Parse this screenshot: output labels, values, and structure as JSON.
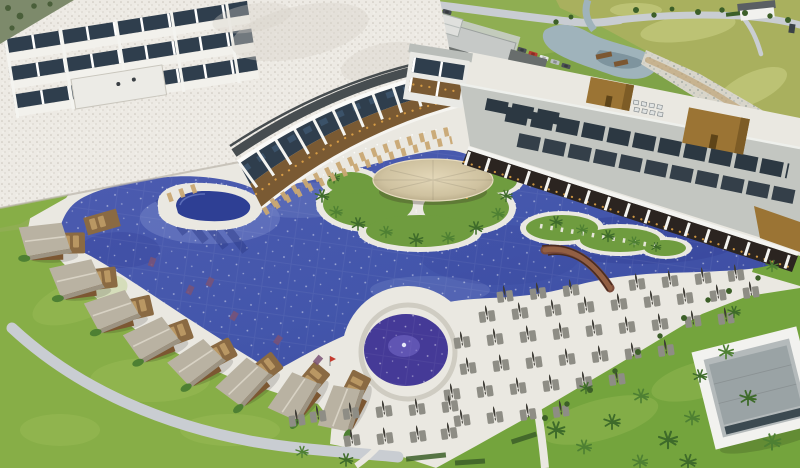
{
  "meta": {
    "type": "aerial-photograph",
    "description": "Aerial view of a luxury resort at dusk: a curved white hotel tower and two colonnaded restaurant wings with warm lit interiors wrap around a huge royal-blue lagoon pool; a thatched swim-up bar sits on a palm-planted island in the middle; thatched-roof cabanas with private decks line the left edge; a round splash pool with a fountain sits at bottom centre; rows of grey sun loungers with closed parasols fill a white deck on the right; lawns, young palms, a stream, rocky banks and golf fairways stretch behind.",
    "width": 800,
    "height": 468
  },
  "palette": {
    "bg_green": "#8fae52",
    "golf": "#a9b05e",
    "golf_light": "#bcc274",
    "lawn": "#87ae47",
    "lawn_bright": "#74a43d",
    "lawn_light": "#a7c45f",
    "terrain": "#7d8a6b",
    "emb": "#7fa348",
    "road": "#c9cdd2",
    "dirt": "#c2a77c",
    "rock": "#d8d5ca",
    "stream": "#9fb3bb",
    "pond_dark": "#7e949e",
    "house_roof": "#5a5f63",
    "white": "#f4f3ef",
    "deck": "#eae8e1",
    "deck_shadow": "#d6d3ca",
    "pool": "#4356ab",
    "pool_hi": "#4d5cb0",
    "pool_lo": "#3a479d",
    "pool_dark": "#36439a",
    "pool_light": "#8291cf",
    "pool_navy": "#2e3f94",
    "pool_purple": "#453a97",
    "island_green": "#6f9c3f",
    "palm": "#3e6b2a",
    "palm_light": "#4e8033",
    "hedge": "#3c5f28",
    "bar_roof_1": "#e3d7b8",
    "bar_roof_2": "#cfc2a0",
    "bar_roof_3": "#a89a78",
    "thatch": "#b9b2a2",
    "thatch_dark": "#9c9382",
    "wood": "#7c5732",
    "wood_deck": "#8a6a43",
    "cab_lounger": "#b99763",
    "facade": "#edeae4",
    "facade_dot": "#c9c4ba",
    "window_dark": "#2f3e4d",
    "window_blue": "#3f5871",
    "roof_dark_band": "#474d50",
    "roof_gray": "#c3c6c1",
    "skylight": "#2c3842",
    "bronze": "#9b7434",
    "bronze_dark": "#7d5c26",
    "interior_dark": "#2b2420",
    "warm": "#e0a347",
    "warm_deep": "#7a5a33",
    "column_white": "#f4f4f0",
    "lounger": "#8e8d85",
    "lounger_tan": "#c9a873",
    "umbrella": "#3f3d37",
    "bridge": "#7a4a3a",
    "bridge_light": "#925f43",
    "ac_unit": "#e0e3e2",
    "car_red": "#b63c30",
    "car_white": "#e8eaea",
    "car_dark": "#4a4f55",
    "car_silver": "#b9bec2",
    "flag_red": "#c43b2e"
  },
  "features": [
    {
      "id": "hotel-tower",
      "label": "white hotel tower with balconies"
    },
    {
      "id": "curved-restaurant-wing",
      "label": "curved two-storey colonnade with lit restaurants"
    },
    {
      "id": "right-restaurant-wing",
      "label": "flat-roofed colonnade wing with skylights"
    },
    {
      "id": "bronze-rooftop-boxes",
      "label": "bronze rooftop volumes"
    },
    {
      "id": "main-pool",
      "label": "free-form lagoon pool"
    },
    {
      "id": "swim-up-bar-island",
      "label": "island with round thatched swim-up bar"
    },
    {
      "id": "stepping-stone-island",
      "label": "planted island with stepping stones"
    },
    {
      "id": "wooden-bridge",
      "label": "arched wooden bridge"
    },
    {
      "id": "cabana-row",
      "label": "thatched cabanas with private pool decks"
    },
    {
      "id": "kidney-pool",
      "label": "small kidney-shaped pool"
    },
    {
      "id": "round-splash-pool",
      "label": "circular splash pool with fountain"
    },
    {
      "id": "sun-lounger-grid",
      "label": "rows of grey loungers with closed parasols"
    },
    {
      "id": "left-lawn",
      "label": "large lawn"
    },
    {
      "id": "stream",
      "label": "stream and pond with rocky banks"
    },
    {
      "id": "golf-course",
      "label": "golf fairways"
    },
    {
      "id": "parking-cars",
      "label": "parked cars"
    },
    {
      "id": "beach-house",
      "label": "white house beyond the road"
    },
    {
      "id": "garden-building",
      "label": "white garden building, bottom right"
    }
  ]
}
